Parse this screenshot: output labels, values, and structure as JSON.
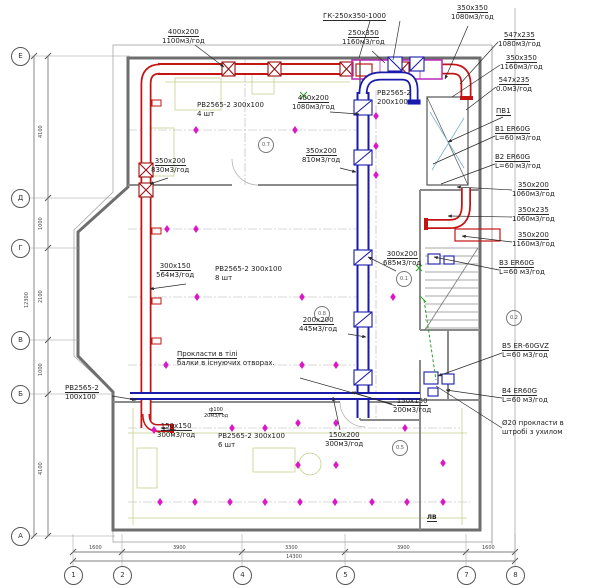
{
  "drawing": {
    "axes": {
      "rows": [
        "Е",
        "Д",
        "Г",
        "В",
        "Б",
        "А"
      ],
      "cols": [
        "1",
        "2",
        "4",
        "5",
        "7",
        "8"
      ],
      "left_dims": [
        "4100",
        "1000",
        "2100",
        "1000",
        "4100"
      ],
      "left_total": "12300",
      "bottom_dims": [
        "1600",
        "3900",
        "3300",
        "3900",
        "1600"
      ],
      "bottom_total": "14300"
    },
    "rooms": [
      "0.7",
      "0.1",
      "0.8",
      "0.2",
      "0.5"
    ],
    "stair_label": "ЛВ",
    "annotations": [
      {
        "l1": "400x200",
        "l2": "1100м3/год"
      },
      {
        "l1": "ГК-250x350-1000"
      },
      {
        "l1": "250x350",
        "l2": "1160м3/год"
      },
      {
        "l1": "350x350",
        "l2": "1080м3/год"
      },
      {
        "l1": "547x235",
        "l2": "1080м3/год"
      },
      {
        "l1": "350x350",
        "l2": "1160м3/год"
      },
      {
        "l1": "547x235",
        "l2": "0.0м3/год"
      },
      {
        "l1": "ПВ1"
      },
      {
        "l1": "B1 ER60G",
        "l2": "L=60 м3/год"
      },
      {
        "l1": "B2 ER60G",
        "l2": "L=60 м3/год"
      },
      {
        "l1": "350x200",
        "l2": "1060м3/год"
      },
      {
        "l1": "350x235",
        "l2": "1060м3/год"
      },
      {
        "l1": "350x200",
        "l2": "1160м3/год"
      },
      {
        "l1": "B3 ER60G",
        "l2": "L=60 м3/год"
      },
      {
        "l1": "B5 ER-60GVZ",
        "l2": "L=60 м3/год"
      },
      {
        "l1": "B4 ER60G",
        "l2": "L=60 м3/год"
      },
      {
        "l1": "Ø20 прокласти в",
        "l2": "штробі з ухилом"
      },
      {
        "l1": "РВ2565-2 300x100",
        "l2": "4 шт"
      },
      {
        "l1": "400x200",
        "l2": "1080м3/год"
      },
      {
        "l1": "РВ2565-2",
        "l2": "200x100"
      },
      {
        "l1": "350x200",
        "l2": "830м3/год"
      },
      {
        "l1": "350x200",
        "l2": "810м3/год"
      },
      {
        "l1": "300x150",
        "l2": "564м3/год"
      },
      {
        "l1": "РВ2565-2 300x100",
        "l2": "8 шт"
      },
      {
        "l1": "300x200",
        "l2": "685м3/год"
      },
      {
        "l1": "200x200",
        "l2": "445м3/год"
      },
      {
        "l1": "Прокласти в тілі",
        "l2": "балки в існуючих отворах."
      },
      {
        "l1": "РВ2565-2",
        "l2": "100x100"
      },
      {
        "l1": "150x150",
        "l2": "300м3/год"
      },
      {
        "l1": "ф100",
        "l2": "20м3/год"
      },
      {
        "l1": "РВ2565-2 300x100",
        "l2": "6 шт"
      },
      {
        "l1": "150x150",
        "l2": "200м3/год"
      },
      {
        "l1": "150x200",
        "l2": "300м3/год"
      }
    ],
    "colors": {
      "supply_duct": "#c41414",
      "exhaust_duct": "#1a1aad",
      "heater_duct": "#b828b8",
      "diffuser": "#dd16c8",
      "room_lines": "#c6cf8a",
      "walls": "#6e6e6e"
    }
  }
}
